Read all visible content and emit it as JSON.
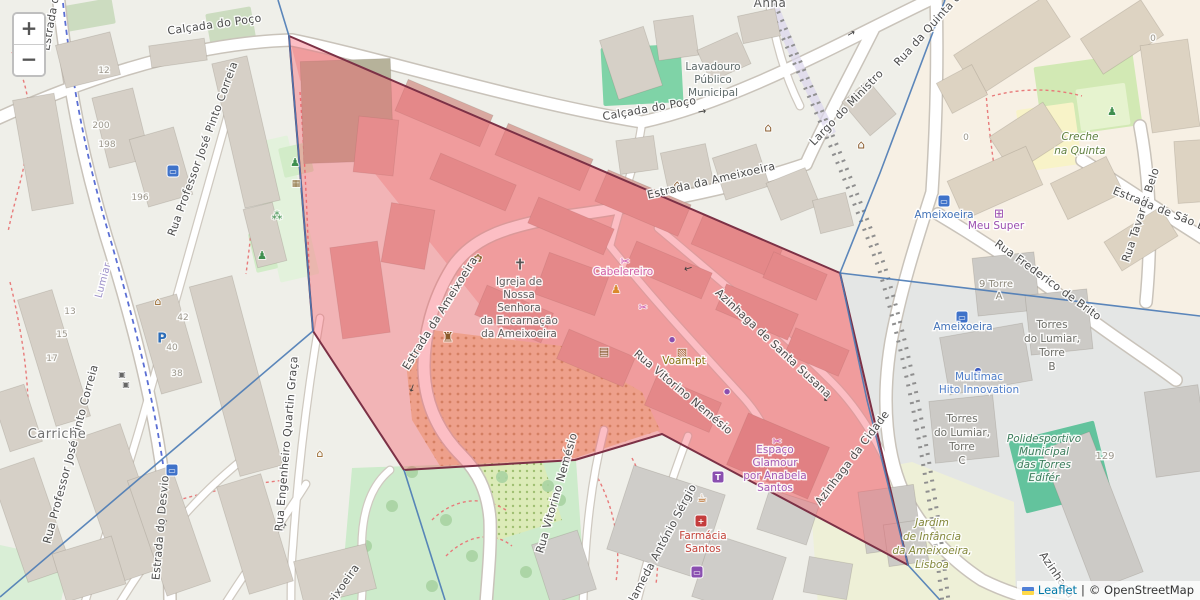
{
  "ui": {
    "zoom_in_label": "+",
    "zoom_out_label": "−",
    "attribution": {
      "leaflet": "Leaflet",
      "separator": "|",
      "osm": "© OpenStreetMap"
    }
  },
  "overlay_region": {
    "fill": "rgba(247,83,99,0.38)",
    "stroke": "#7c3146",
    "points": [
      [
        289,
        36
      ],
      [
        840,
        273
      ],
      [
        908,
        565
      ],
      [
        662,
        434
      ],
      [
        575,
        460
      ],
      [
        404,
        470
      ],
      [
        313,
        331
      ]
    ]
  },
  "admin_boundaries": {
    "color": "#4a7ab5",
    "lines": [
      [
        [
          278,
          0
        ],
        [
          289,
          36
        ],
        [
          313,
          331
        ],
        [
          0,
          597
        ]
      ],
      [
        [
          404,
          470
        ],
        [
          445,
          600
        ]
      ],
      [
        [
          945,
          0
        ],
        [
          880,
          173
        ],
        [
          840,
          273
        ]
      ],
      [
        [
          840,
          273
        ],
        [
          1200,
          316
        ]
      ],
      [
        [
          840,
          273
        ],
        [
          867,
          400
        ],
        [
          908,
          565
        ],
        [
          940,
          600
        ]
      ]
    ]
  },
  "street_labels": [
    {
      "t": "Calçada do Poço",
      "x": 215,
      "y": 28,
      "r": -8
    },
    {
      "t": "Calçada do Poço",
      "x": 650,
      "y": 112,
      "r": -10
    },
    {
      "t": "Estrada da Ameixoeira",
      "x": 712,
      "y": 184,
      "r": -13
    },
    {
      "t": "Estrada da Ameixoeira",
      "x": 443,
      "y": 315,
      "r": -58
    },
    {
      "t": "Largo do Ministro",
      "x": 849,
      "y": 110,
      "r": -46
    },
    {
      "t": "Rua da Quinta d",
      "x": 930,
      "y": 32,
      "r": -48
    },
    {
      "t": "Rua Tavares Belo",
      "x": 1144,
      "y": 216,
      "r": -72
    },
    {
      "t": "Estrada de São B",
      "x": 1158,
      "y": 212,
      "r": 22
    },
    {
      "t": "Rua Frederico de Brito",
      "x": 1046,
      "y": 283,
      "r": 36
    },
    {
      "t": "Azinhaga de Santa Susana",
      "x": 771,
      "y": 346,
      "r": 43
    },
    {
      "t": "Azinhaga da Cidade",
      "x": 855,
      "y": 460,
      "r": -53
    },
    {
      "t": "Azinhaga",
      "x": 1054,
      "y": 577,
      "r": 56
    },
    {
      "t": "Rua Vitorino Nemésio",
      "x": 681,
      "y": 395,
      "r": 40
    },
    {
      "t": "Rua Vitorino Nemésio",
      "x": 560,
      "y": 494,
      "r": -74
    },
    {
      "t": "Alameda António Sérgio",
      "x": 664,
      "y": 548,
      "r": -62
    },
    {
      "t": "Rua Professor José Pinto Correia",
      "x": 206,
      "y": 150,
      "r": -70
    },
    {
      "t": "Rua Professor José Pinto Correia",
      "x": 74,
      "y": 455,
      "r": -75
    },
    {
      "t": "Rua Engenheiro Quartin Graça",
      "x": 290,
      "y": 444,
      "r": -85
    },
    {
      "t": "Estrada do Desvio",
      "x": 164,
      "y": 528,
      "r": -85
    },
    {
      "t": "Estrada d",
      "x": 54,
      "y": 24,
      "r": -80
    },
    {
      "t": "Ameixoeira",
      "x": 341,
      "y": 594,
      "r": -55
    },
    {
      "t": "Lumiar",
      "x": 106,
      "y": 281,
      "r": -75,
      "c": "#9b8fc9",
      "s": 10
    }
  ],
  "place_labels": [
    {
      "t": "Carriche",
      "x": 57,
      "y": 438,
      "s": 13,
      "c": "#707070"
    },
    {
      "t": "Anna",
      "x": 770,
      "y": 7,
      "s": 12,
      "c": "#5a5a5a"
    }
  ],
  "poi_labels": [
    {
      "t": "Lavadouro",
      "x": 713,
      "y": 70,
      "c": "#5f6b6b"
    },
    {
      "t": "Público",
      "x": 713,
      "y": 83,
      "c": "#5f6b6b"
    },
    {
      "t": "Municipal",
      "x": 713,
      "y": 96,
      "c": "#5f6b6b"
    },
    {
      "t": "Creche",
      "x": 1080,
      "y": 140,
      "c": "#5e7f3f",
      "i": true
    },
    {
      "t": "na Quinta",
      "x": 1080,
      "y": 154,
      "c": "#5e7f3f",
      "i": true
    },
    {
      "t": "Meu Super",
      "x": 996,
      "y": 229,
      "c": "#9b4fb0"
    },
    {
      "t": "Ameixoeira",
      "x": 944,
      "y": 218,
      "c": "#4272b8"
    },
    {
      "t": "Ameixoeira",
      "x": 963,
      "y": 330,
      "c": "#4272b8"
    },
    {
      "t": "9 Torre",
      "x": 996,
      "y": 287,
      "c": "#8e897c",
      "s": 10
    },
    {
      "t": "A",
      "x": 999,
      "y": 299,
      "c": "#8e897c",
      "s": 10
    },
    {
      "t": "Torres",
      "x": 1052,
      "y": 328,
      "c": "#6e6e68"
    },
    {
      "t": "do Lumiar,",
      "x": 1052,
      "y": 342,
      "c": "#6e6e68"
    },
    {
      "t": "Torre",
      "x": 1052,
      "y": 356,
      "c": "#6e6e68"
    },
    {
      "t": "B",
      "x": 1052,
      "y": 370,
      "c": "#6e6e68"
    },
    {
      "t": "Multimac",
      "x": 979,
      "y": 380,
      "c": "#4f7ec9"
    },
    {
      "t": "Hito Innovation",
      "x": 979,
      "y": 393,
      "c": "#4f7ec9"
    },
    {
      "t": "Torres",
      "x": 962,
      "y": 422,
      "c": "#6e6e68"
    },
    {
      "t": "do Lumiar,",
      "x": 962,
      "y": 436,
      "c": "#6e6e68"
    },
    {
      "t": "Torre",
      "x": 962,
      "y": 450,
      "c": "#6e6e68"
    },
    {
      "t": "C",
      "x": 962,
      "y": 464,
      "c": "#6e6e68"
    },
    {
      "t": "Polidesportivo",
      "x": 1044,
      "y": 442,
      "c": "#3c7d5c",
      "i": true
    },
    {
      "t": "Municipal",
      "x": 1044,
      "y": 455,
      "c": "#3c7d5c",
      "i": true
    },
    {
      "t": "das Torres",
      "x": 1044,
      "y": 468,
      "c": "#3c7d5c",
      "i": true
    },
    {
      "t": "Edifér",
      "x": 1044,
      "y": 481,
      "c": "#3c7d5c",
      "i": true
    },
    {
      "t": "Jardim",
      "x": 932,
      "y": 526,
      "c": "#84883c",
      "i": true
    },
    {
      "t": "de Infância",
      "x": 932,
      "y": 540,
      "c": "#84883c",
      "i": true
    },
    {
      "t": "da Ameixoeira,",
      "x": 932,
      "y": 554,
      "c": "#84883c",
      "i": true
    },
    {
      "t": "Lisboa",
      "x": 932,
      "y": 568,
      "c": "#84883c",
      "i": true
    },
    {
      "t": "Igreja de",
      "x": 519,
      "y": 285,
      "c": "#5f5f5f"
    },
    {
      "t": "Nossa",
      "x": 519,
      "y": 298,
      "c": "#5f5f5f"
    },
    {
      "t": "Senhora",
      "x": 519,
      "y": 311,
      "c": "#5f5f5f"
    },
    {
      "t": "da Encarnação",
      "x": 519,
      "y": 324,
      "c": "#5f5f5f"
    },
    {
      "t": "da Ameixoeira",
      "x": 519,
      "y": 337,
      "c": "#5f5f5f"
    },
    {
      "t": "Cabelereiro",
      "x": 623,
      "y": 275,
      "c": "#d060a8"
    },
    {
      "t": "Voam.pt",
      "x": 684,
      "y": 364,
      "c": "#857313"
    },
    {
      "t": "Espaço",
      "x": 775,
      "y": 453,
      "c": "#a45ab5"
    },
    {
      "t": "Glamour",
      "x": 775,
      "y": 466,
      "c": "#a45ab5"
    },
    {
      "t": "por Anabela",
      "x": 775,
      "y": 479,
      "c": "#a45ab5"
    },
    {
      "t": "Santos",
      "x": 775,
      "y": 491,
      "c": "#a45ab5"
    },
    {
      "t": "Farmácia",
      "x": 703,
      "y": 539,
      "c": "#c4453c"
    },
    {
      "t": "Santos",
      "x": 703,
      "y": 552,
      "c": "#c4453c"
    }
  ],
  "house_numbers": [
    {
      "t": "12",
      "x": 104,
      "y": 73
    },
    {
      "t": "200",
      "x": 101,
      "y": 128
    },
    {
      "t": "198",
      "x": 107,
      "y": 147
    },
    {
      "t": "196",
      "x": 140,
      "y": 200
    },
    {
      "t": "13",
      "x": 70,
      "y": 314
    },
    {
      "t": "15",
      "x": 62,
      "y": 337
    },
    {
      "t": "17",
      "x": 52,
      "y": 361
    },
    {
      "t": "42",
      "x": 183,
      "y": 320
    },
    {
      "t": "40",
      "x": 172,
      "y": 350
    },
    {
      "t": "38",
      "x": 177,
      "y": 376
    },
    {
      "t": "129",
      "x": 1105,
      "y": 459,
      "s": 10
    },
    {
      "t": "0",
      "x": 966,
      "y": 140
    },
    {
      "t": "0",
      "x": 1153,
      "y": 41
    }
  ],
  "icons": [
    {
      "n": "church-cross-icon",
      "x": 520,
      "y": 264,
      "g": "✝",
      "c": "#555555",
      "s": 15
    },
    {
      "n": "flower-icon",
      "x": 478,
      "y": 258,
      "g": "✿",
      "c": "#8a6d3b",
      "s": 11
    },
    {
      "n": "castle-icon",
      "x": 448,
      "y": 337,
      "g": "♜",
      "c": "#8a5a2b",
      "s": 13
    },
    {
      "n": "library-book-icon",
      "x": 604,
      "y": 351,
      "g": "▤",
      "c": "#7a4f1f",
      "s": 11
    },
    {
      "n": "monument-icon",
      "x": 677,
      "y": 184,
      "g": "⌂",
      "c": "#8a5a2b",
      "s": 12
    },
    {
      "n": "monument-icon",
      "x": 768,
      "y": 127,
      "g": "⌂",
      "c": "#8a5a2b",
      "s": 12
    },
    {
      "n": "monument-icon",
      "x": 861,
      "y": 144,
      "g": "⌂",
      "c": "#8a5a2b",
      "s": 12
    },
    {
      "n": "picnic-icon",
      "x": 296,
      "y": 183,
      "g": "▦",
      "c": "#8a6d3b",
      "s": 9
    },
    {
      "n": "playground-icon",
      "x": 295,
      "y": 162,
      "g": "♟",
      "c": "#3f8f4f",
      "s": 11
    },
    {
      "n": "paw-icon",
      "x": 277,
      "y": 215,
      "g": "⁂",
      "c": "#3f8f4f",
      "s": 11
    },
    {
      "n": "fitness-icon",
      "x": 262,
      "y": 255,
      "g": "♟",
      "c": "#3f8f4f",
      "s": 11
    },
    {
      "n": "shop-icon",
      "x": 158,
      "y": 301,
      "g": "⌂",
      "c": "#9a6a2f",
      "s": 11
    },
    {
      "n": "shop-icon",
      "x": 320,
      "y": 453,
      "g": "⌂",
      "c": "#9a6a2f",
      "s": 11
    },
    {
      "n": "parking-icon",
      "x": 162,
      "y": 338,
      "g": "P",
      "c": "#2b6cb8",
      "s": 13,
      "b": true
    },
    {
      "n": "elevator-icon",
      "x": 122,
      "y": 374,
      "g": "▣",
      "c": "#666666",
      "s": 8
    },
    {
      "n": "elevator-icon",
      "x": 126,
      "y": 384,
      "g": "▣",
      "c": "#666666",
      "s": 8
    },
    {
      "n": "bus-stop-icon",
      "x": 173,
      "y": 171,
      "g": "▭",
      "c": "#ffffff",
      "bg": "#3f72c9"
    },
    {
      "n": "bus-stop-icon",
      "x": 172,
      "y": 470,
      "g": "▭",
      "c": "#ffffff",
      "bg": "#3f72c9"
    },
    {
      "n": "train-station-icon",
      "x": 944,
      "y": 201,
      "g": "▭",
      "c": "#ffffff",
      "bg": "#3f72c9"
    },
    {
      "n": "train-station-icon",
      "x": 962,
      "y": 317,
      "g": "▭",
      "c": "#ffffff",
      "bg": "#3f72c9"
    },
    {
      "n": "cart-icon",
      "x": 999,
      "y": 213,
      "g": "⊞",
      "c": "#9b4fb0",
      "s": 12
    },
    {
      "n": "hairdresser-icon",
      "x": 625,
      "y": 261,
      "g": "✂",
      "c": "#c94fae",
      "s": 11
    },
    {
      "n": "beauty-icon",
      "x": 643,
      "y": 307,
      "g": "✂",
      "c": "#c94fae",
      "s": 10
    },
    {
      "n": "restaurant-people-icon",
      "x": 616,
      "y": 289,
      "g": "♟",
      "c": "#d98a2b",
      "s": 11
    },
    {
      "n": "package-box-icon",
      "x": 682,
      "y": 352,
      "g": "▧",
      "c": "#9a5f2b",
      "s": 11
    },
    {
      "n": "poi-dot-icon",
      "x": 672,
      "y": 339,
      "g": "●",
      "c": "#8a4fb0",
      "s": 7
    },
    {
      "n": "poi-dot-icon",
      "x": 727,
      "y": 391,
      "g": "●",
      "c": "#8a4fb0",
      "s": 7
    },
    {
      "n": "poi-dot-icon",
      "x": 978,
      "y": 370,
      "g": "●",
      "c": "#3b5bc4",
      "s": 8
    },
    {
      "n": "hairdresser-icon",
      "x": 777,
      "y": 441,
      "g": "✂",
      "c": "#c94fae",
      "s": 11
    },
    {
      "n": "clothes-icon",
      "x": 718,
      "y": 477,
      "g": "T",
      "c": "#ffffff",
      "bg": "#8a4fb0"
    },
    {
      "n": "cafe-icon",
      "x": 702,
      "y": 498,
      "g": "☕",
      "c": "#b8651b",
      "s": 11
    },
    {
      "n": "pharmacy-icon",
      "x": 701,
      "y": 521,
      "g": "+",
      "c": "#ffffff",
      "bg": "#c43c3c"
    },
    {
      "n": "computer-icon",
      "x": 697,
      "y": 572,
      "g": "▭",
      "c": "#ffffff",
      "bg": "#8a4fb0"
    },
    {
      "n": "playground-icon",
      "x": 1112,
      "y": 111,
      "g": "♟",
      "c": "#3f8f4f",
      "s": 11
    }
  ],
  "oneway_arrows": [
    {
      "x": 851,
      "y": 33,
      "r": -30,
      "g": "→"
    },
    {
      "x": 702,
      "y": 111,
      "r": -8,
      "g": "→"
    },
    {
      "x": 688,
      "y": 268,
      "r": -15,
      "g": "←"
    },
    {
      "x": 827,
      "y": 398,
      "r": -38,
      "g": "←"
    },
    {
      "x": 174,
      "y": 228,
      "r": 8,
      "g": "↑"
    },
    {
      "x": 165,
      "y": 523,
      "r": 0,
      "g": "↑"
    },
    {
      "x": 412,
      "y": 388,
      "r": 20,
      "g": "↓"
    },
    {
      "x": 284,
      "y": 527,
      "r": 10,
      "g": "↑"
    }
  ]
}
